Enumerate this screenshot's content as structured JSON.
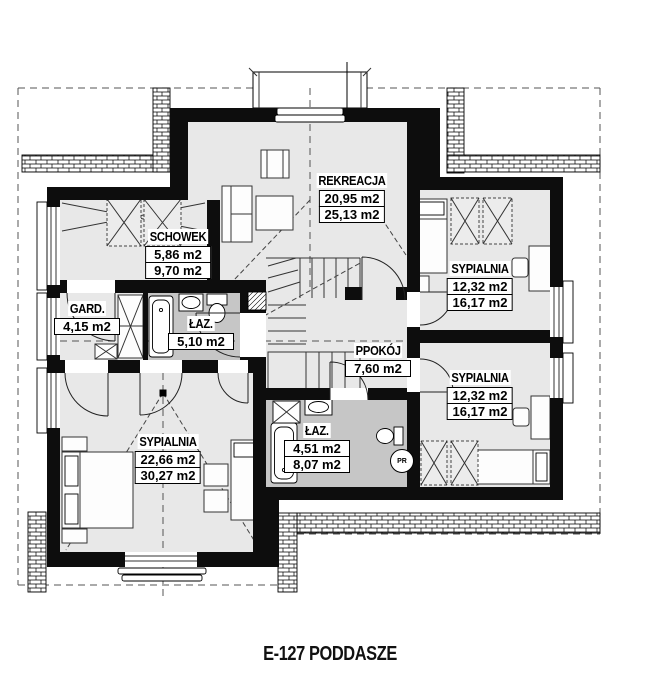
{
  "title": "E-127 PODDASZE",
  "colors": {
    "floor": "#e8e8e8",
    "bath": "#c6c6c6",
    "wall": "#0d0d0d"
  },
  "appliances": {
    "washer_label": "PR"
  },
  "rooms": [
    {
      "key": "rekreacja",
      "name": "REKREACJA",
      "area_usable": "20,95 m2",
      "area_floor": "25,13 m2"
    },
    {
      "key": "schowek",
      "name": "SCHOWEK",
      "area_usable": "5,86 m2",
      "area_floor": "9,70 m2"
    },
    {
      "key": "sypialnia-top-right",
      "name": "SYPIALNIA",
      "area_usable": "12,32 m2",
      "area_floor": "16,17 m2"
    },
    {
      "key": "sypialnia-bottom-right",
      "name": "SYPIALNIA",
      "area_usable": "12,32 m2",
      "area_floor": "16,17 m2"
    },
    {
      "key": "garderoba",
      "name": "GARD.",
      "area_usable": "4,15 m2"
    },
    {
      "key": "lazienka-gorna",
      "name": "ŁAZ.",
      "area_usable": "5,10 m2"
    },
    {
      "key": "przedpokoj",
      "name": "PPOKÓJ",
      "area_usable": "7,60 m2"
    },
    {
      "key": "lazienka-dolna",
      "name": "ŁAZ.",
      "area_usable": "4,51 m2",
      "area_floor": "8,07 m2"
    },
    {
      "key": "sypialnia-master",
      "name": "SYPIALNIA",
      "area_usable": "22,66 m2",
      "area_floor": "30,27 m2"
    }
  ]
}
